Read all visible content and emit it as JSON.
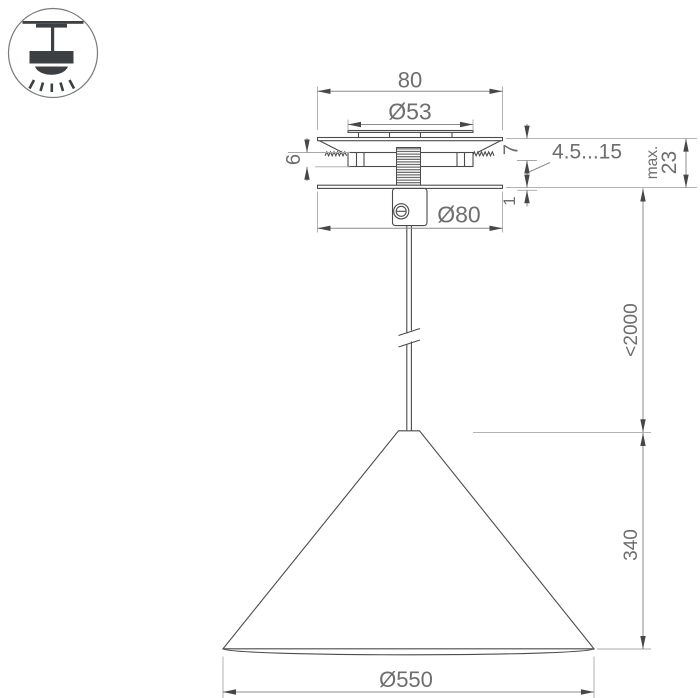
{
  "drawing_title": "pendant-lamp-mounting-drawing",
  "dimensions": {
    "canopy_width": "80",
    "hole_diameter": "Ø53",
    "spring_clip_height": "6",
    "flange_height": "7",
    "ceiling_thickness_range": "4.5...15",
    "base_gap": "1",
    "max_label": "max.",
    "max_value": "23",
    "base_diameter": "Ø80",
    "cable_length": "<2000",
    "shade_height": "340",
    "shade_diameter": "Ø550"
  },
  "colors": {
    "background": "#ffffff",
    "object_line": "#4b4b4b",
    "dimension_line": "#8c8c8c",
    "extension_line": "#a8a8a8",
    "dimension_text": "#6e6e6e",
    "icon_glyph": "#3c4043"
  }
}
